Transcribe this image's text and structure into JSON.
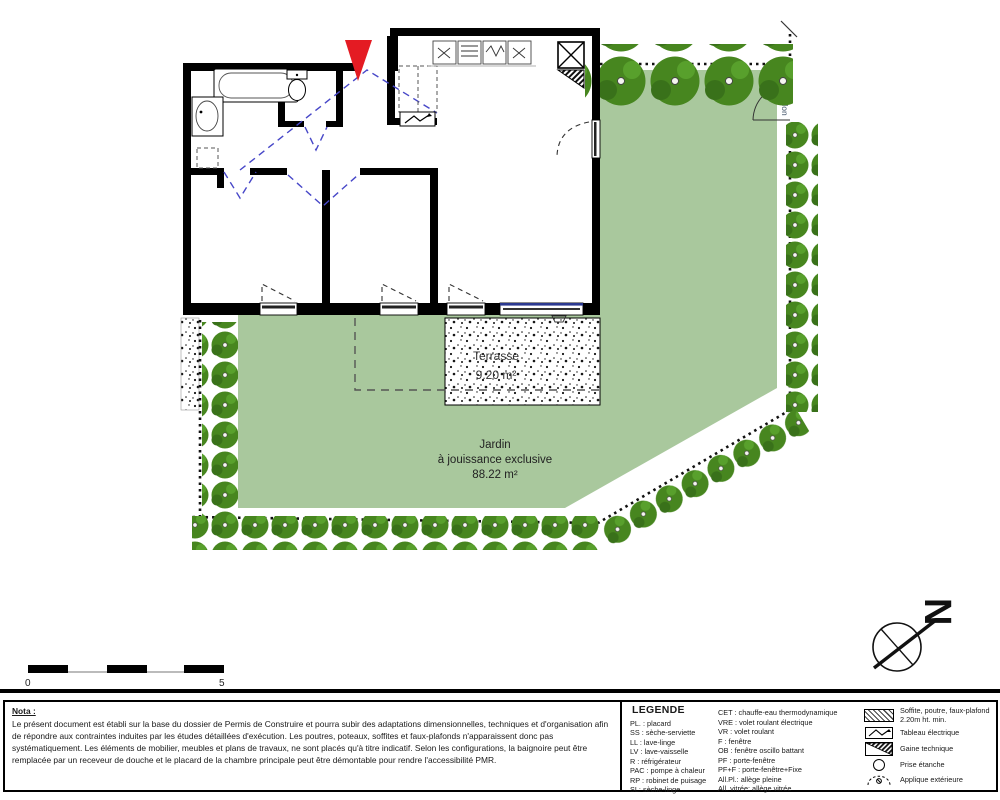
{
  "plan": {
    "terrace": {
      "label": "Terrasse",
      "area": "9.20 m²"
    },
    "garden": {
      "line1": "Jardin",
      "line2": "à jouissance exclusive",
      "area": "88.22 m²"
    },
    "gate_label": "Portillon",
    "compass_label": "N",
    "scale": {
      "start": "0",
      "end": "5"
    },
    "colors": {
      "garden_green": "#a9c89d",
      "hedge_green": "#47861f",
      "wall_black": "#000000",
      "door_swing_blue": "#4747c8",
      "entrance_red": "#e41b23",
      "shutter_blue": "#2b3990"
    }
  },
  "nota": {
    "title": "Nota :",
    "body": "Le présent document est établi sur la base du dossier de Permis de Construire et pourra subir des adaptations dimensionnelles, techniques et d'organisation afin de répondre aux contraintes induites par les études détaillées d'exécution. Les poutres, poteaux, soffites et faux-plafonds n'apparaissent donc pas systématiquement. Les éléments de mobilier, meubles et plans de travaux, ne sont placés qu'à titre indicatif. Selon les configurations, la baignoire peut être remplacée par un receveur de douche et le placard de la chambre principale peut être démontable pour rendre l'accessibilité PMR."
  },
  "legend": {
    "title": "LEGENDE",
    "items_left": [
      "PL. :  placard",
      "SS :  sèche-serviette",
      "LL :  lave-linge",
      "LV :  lave-vaisselle",
      "R :  réfrigérateur",
      "PAC : pompe à chaleur",
      "RP :  robinet de puisage",
      "SL:  sèche-linge"
    ],
    "items_middle": [
      "CET : chauffe-eau thermodynamique",
      "VRE : volet roulant électrique",
      "VR :  volet roulant",
      "F : fenêtre",
      "OB : fenêtre oscillo battant",
      "PF :  porte-fenêtre",
      "PF+F : porte-fenêtre+Fixe",
      "All.Pl.: allège pleine",
      "All. vitrée: allège vitrée"
    ],
    "items_symbols": [
      {
        "symbol": "soffit-hatch",
        "label": "Soffite, poutre, faux-plafond 2.20m ht. min."
      },
      {
        "symbol": "electrical-panel",
        "label": "Tableau électrique"
      },
      {
        "symbol": "technical-duct",
        "label": "Gaine technique"
      },
      {
        "symbol": "waterproof-socket",
        "label": "Prise étanche"
      },
      {
        "symbol": "exterior-light",
        "label": "Applique extérieure"
      }
    ]
  }
}
